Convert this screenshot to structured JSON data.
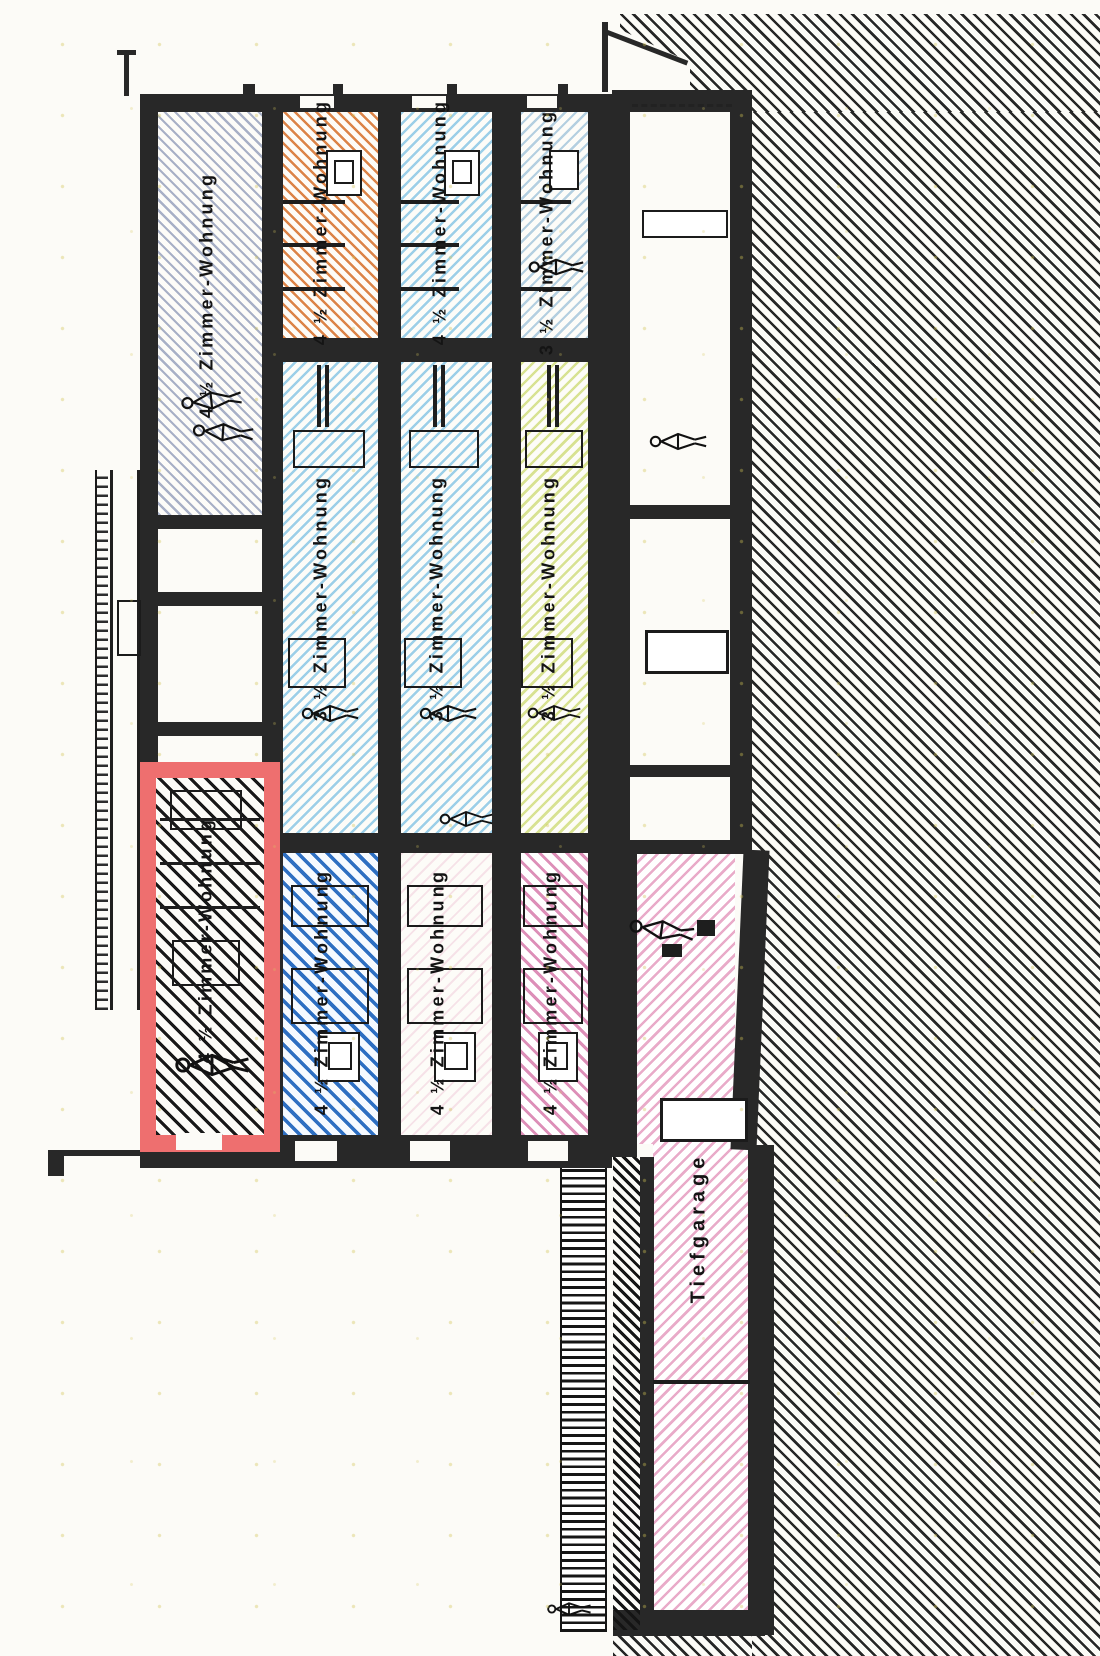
{
  "drawing": {
    "kind_label": "building section with apartment units",
    "units": {
      "a1": "4 ½ Zimmer-Wohnung",
      "b1": "4 ½ Zimmer-Wohnung",
      "c1": "4 ½ Zimmer-Wohnung",
      "d1": "3 ½ Zimmer-Wohnung",
      "b2": "3 ½ Zimmer-Wohnung",
      "c2": "3 ½ Zimmer-Wohnung",
      "d2": "3 ½ Zimmer-Wohnung",
      "red": "4 ½ Zimmer-Wohnung",
      "b3": "4 ½ Zimmer-Wohnung",
      "c3": "4 ½ Zimmer-Wohnung",
      "d3": "4 ½ Zimmer-Wohnung"
    },
    "garage": {
      "label": "Tiefgarage"
    },
    "colors": {
      "highlight_red": "#ee6f6f",
      "orange_unit": "#dc8448",
      "light_blue_unit": "#9ccfe8",
      "gray_blue_unit": "#a8b0c6",
      "yellow_unit": "#d8e292",
      "dark_blue_unit": "#2e6fc2",
      "pink_unit": "#dd8fb8",
      "garage_pink": "#e9abc9",
      "wall": "#282828"
    }
  }
}
